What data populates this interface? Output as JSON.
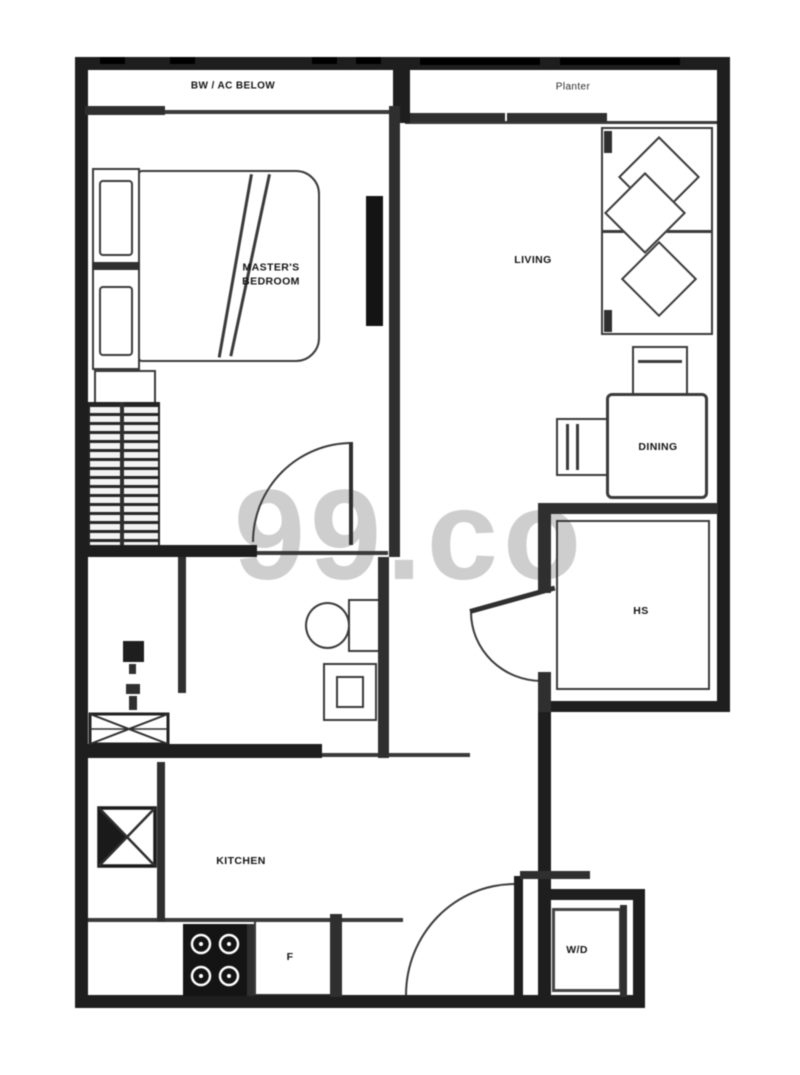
{
  "watermark": {
    "text": "99.co"
  },
  "colors": {
    "wall": "#1e1e1e",
    "furniture_line": "#3a3a3a",
    "watermark": "#b1b1b1",
    "background": "#ffffff"
  },
  "labels": {
    "bw_ac_below": "BW / AC BELOW",
    "planter": "Planter",
    "master_bedroom_line1": "MASTER'S",
    "master_bedroom_line2": "BEDROOM",
    "living": "LIVING",
    "dining": "DINING",
    "household_shelter": "HS",
    "kitchen": "KITCHEN",
    "fridge": "F",
    "washer_dryer": "W/D"
  }
}
